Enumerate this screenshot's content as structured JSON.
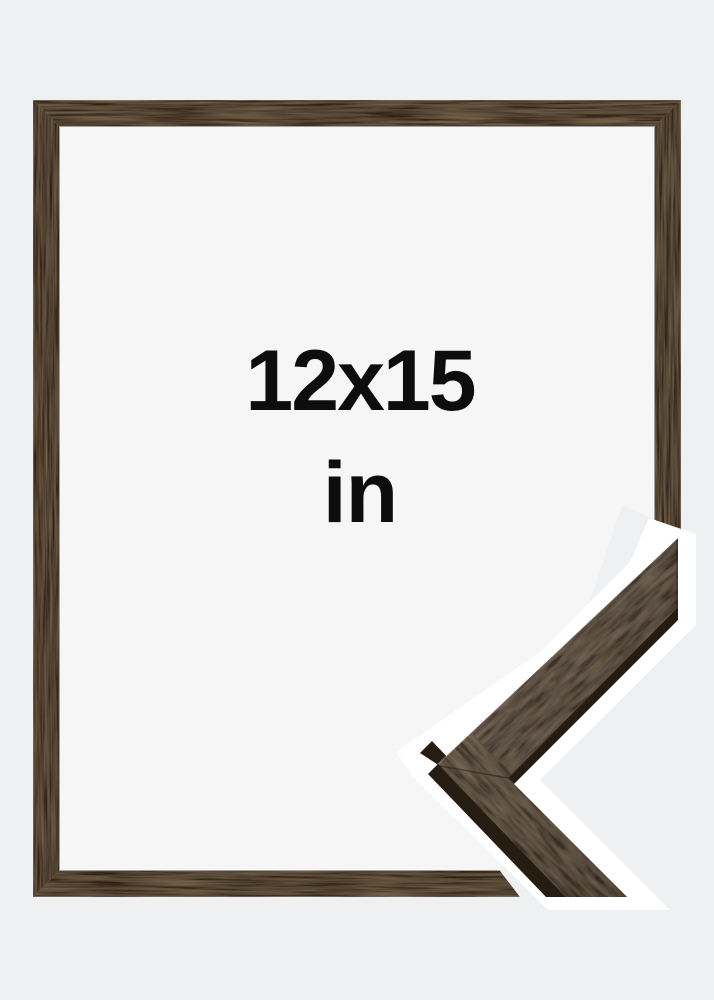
{
  "product": {
    "size_label": "12x15",
    "unit_label": "in"
  },
  "colors": {
    "background": "#eff0f2",
    "inner_background": "#f6f6f7",
    "wood_face": "#4b3b2a",
    "wood_face_vertical": "#443527",
    "corner_wood_upper": "#52443a",
    "corner_wood_lower": "#584a3c",
    "wood_dark_edge": "#261d12",
    "sticker_outline": "#ffffff",
    "text": "#0d0d0d"
  }
}
